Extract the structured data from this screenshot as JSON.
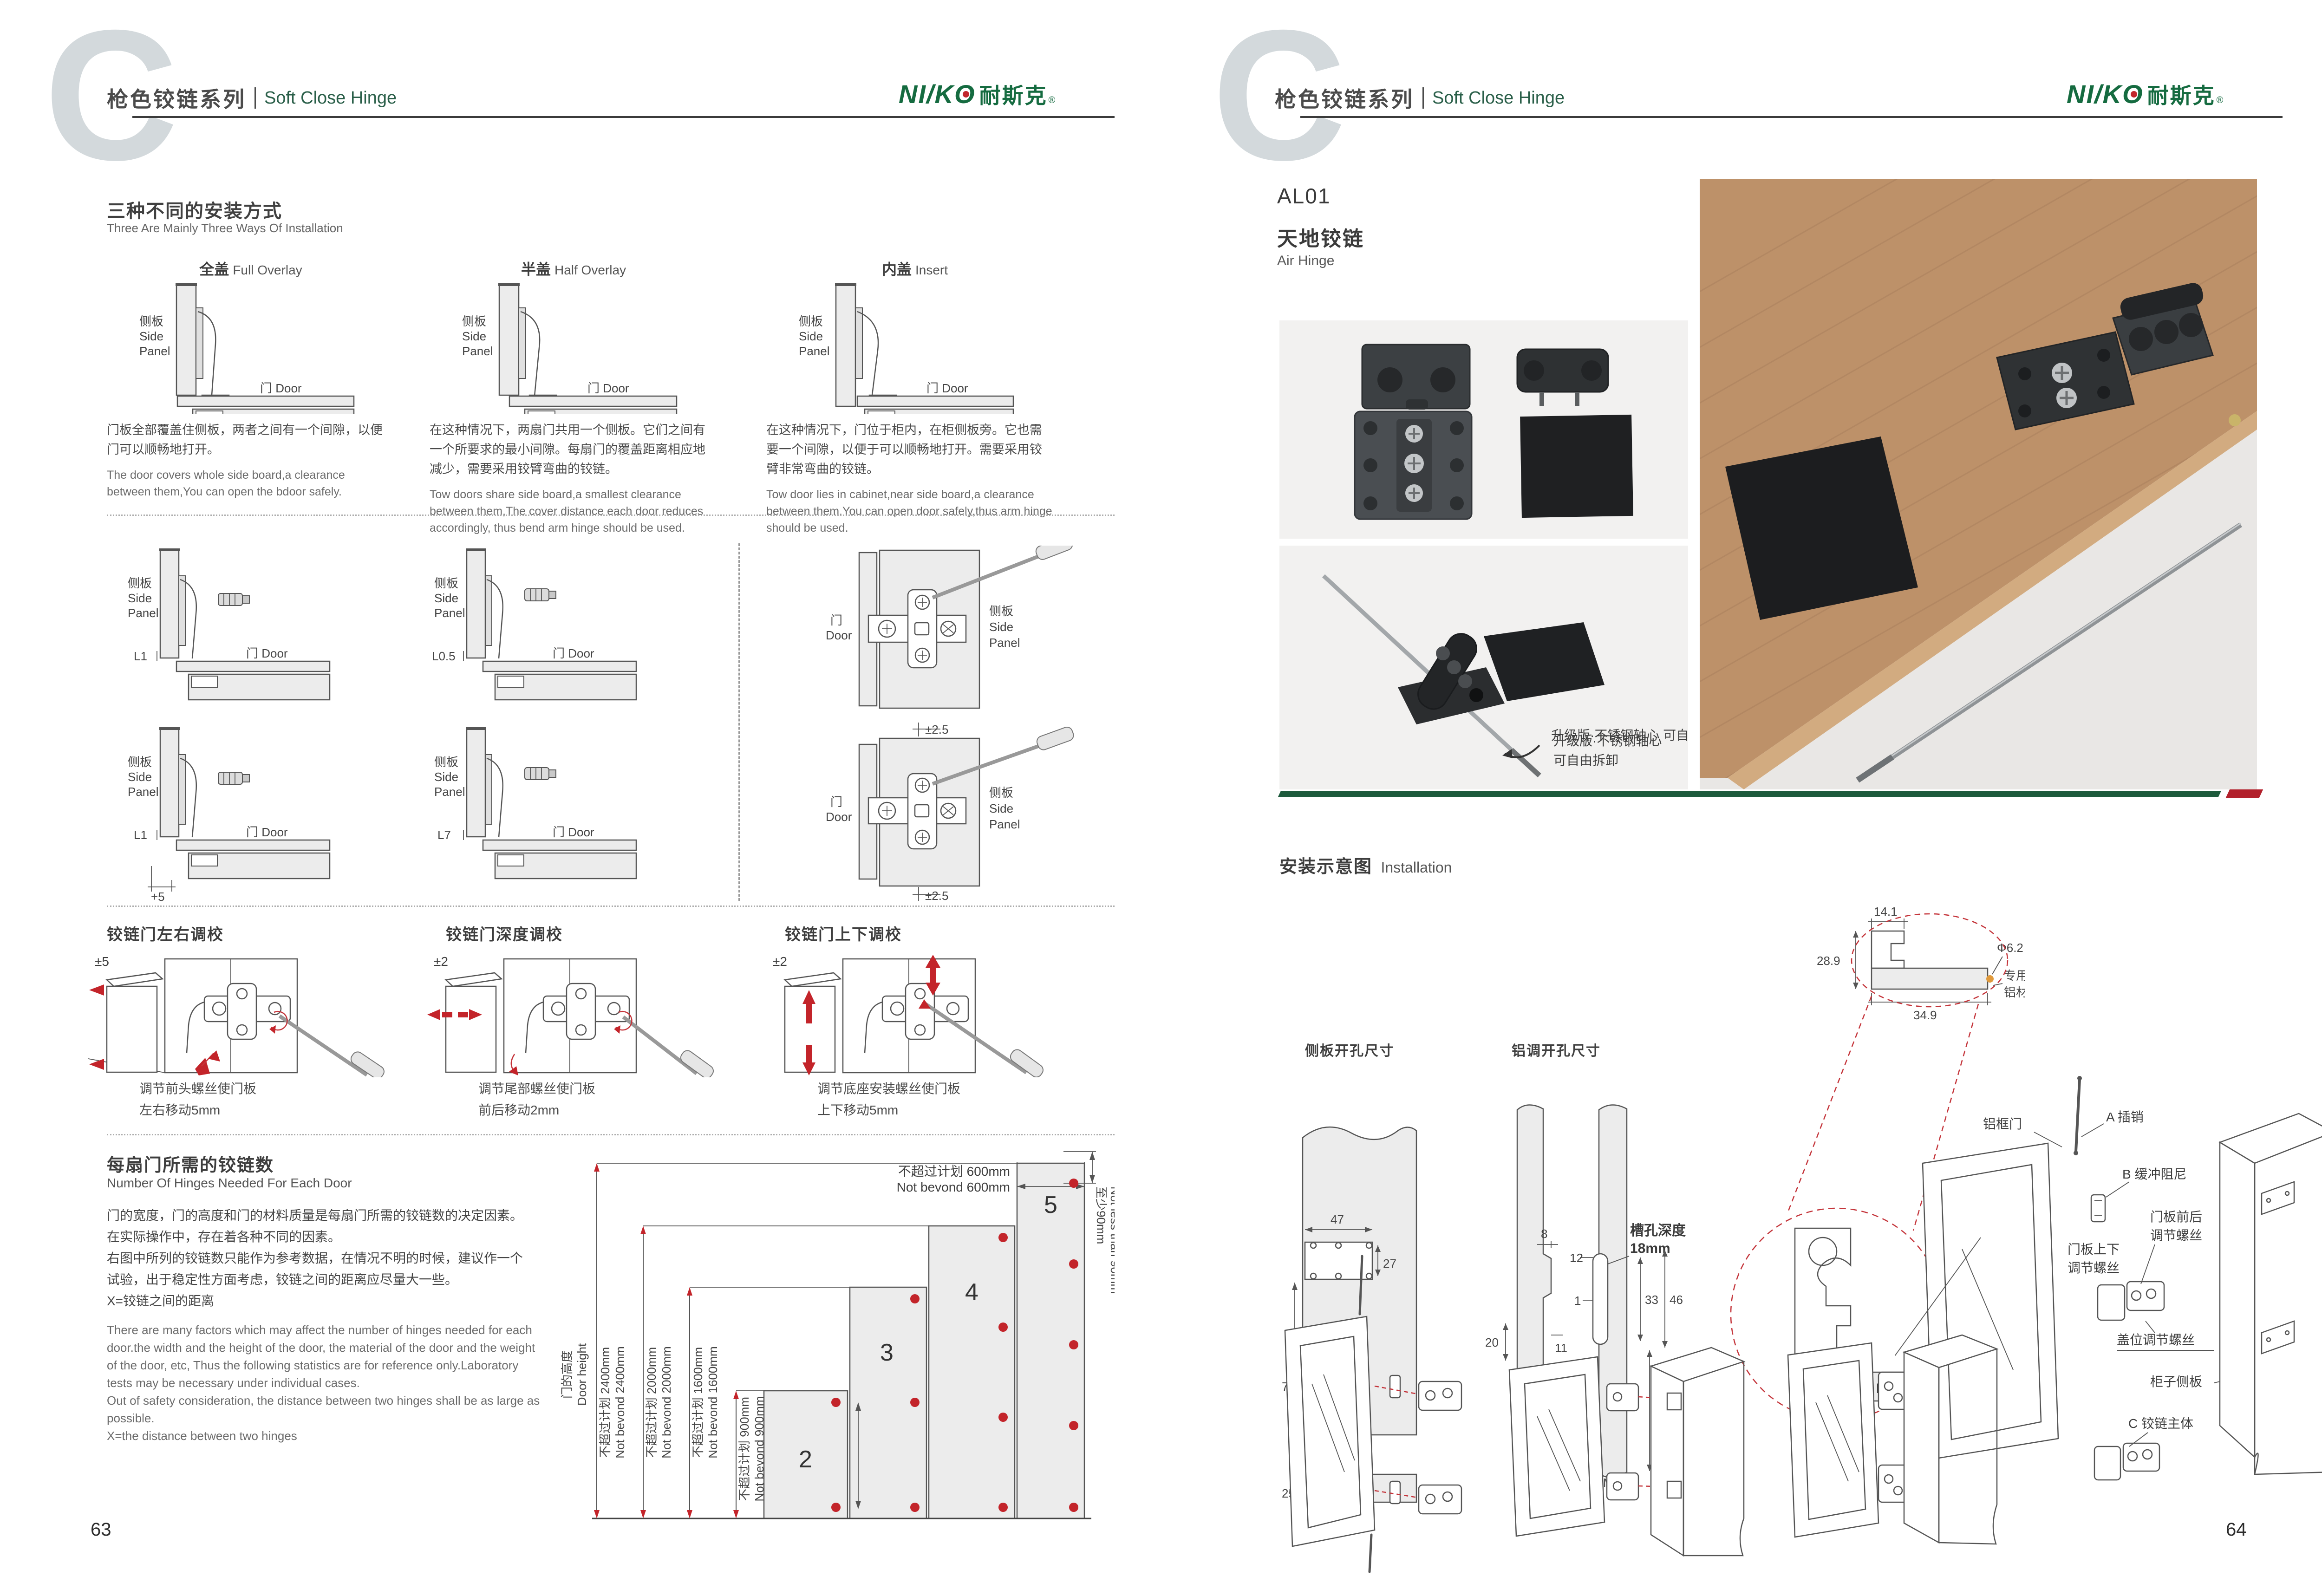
{
  "colors": {
    "brand_green": "#156b40",
    "accent_red": "#c0242b",
    "divider_green": "#1d5a3c",
    "header_gray": "#4b4b4b",
    "header_en_green": "#2a5f49"
  },
  "brand": {
    "logo_part1": "NI/K",
    "logo_o": "O",
    "logo_cn": "耐斯克",
    "reg": "®"
  },
  "header": {
    "series_cn": "枪色铰链系列",
    "series_en": "Soft Close Hinge",
    "watermark": "C"
  },
  "common": {
    "side_cn": "侧板",
    "side_en1": "Side",
    "side_en2": "Panel",
    "door": "门 Door",
    "door_cn": "门",
    "door_en": "Door"
  },
  "page_left": {
    "page_number": "63",
    "ways": {
      "title_cn": "三种不同的安装方式",
      "title_en": "Three Are Mainly Three Ways Of Installation",
      "cols": [
        {
          "cn": "全盖",
          "en": "Full Overlay",
          "desc_cn": "门板全部覆盖住侧板，两者之间有一个间隙，以便门可以顺畅地打开。",
          "desc_en": "The door covers whole side board,a clearance between them,You can open the bdoor safely."
        },
        {
          "cn": "半盖",
          "en": "Half Overlay",
          "desc_cn": "在这种情况下，两扇门共用一个侧板。它们之间有一个所要求的最小间隙。每扇门的覆盖距离相应地减少，需要采用铰臂弯曲的铰链。",
          "desc_en": "Tow doors share side board,a smallest clearance between them,The cover distance each door reduces accordingly, thus bend arm hinge should be used."
        },
        {
          "cn": "内盖",
          "en": "Insert",
          "desc_cn": "在这种情况下，门位于柜内，在柜侧板旁。它也需要一个间隙，以便于可以顺畅地打开。需要采用铰臂非常弯曲的铰链。",
          "desc_en": "Tow door lies in cabinet,near side board,a clearance between them.You can open door safely,thus arm hinge should be used."
        }
      ]
    },
    "gaps": {
      "dims": [
        "L1",
        "L0.5",
        "L1",
        "L7"
      ],
      "plus5": "+5",
      "pm_top": "±2.5",
      "pm_bottom": "±2.5"
    },
    "adjust": {
      "items": [
        {
          "title": "铰链门左右调校",
          "range": "±5",
          "caption": "调节前头螺丝使门板\n左右移动5mm"
        },
        {
          "title": "铰链门深度调校",
          "range": "±2",
          "caption": "调节尾部螺丝使门板\n前后移动2mm"
        },
        {
          "title": "铰链门上下调校",
          "range": "±2",
          "caption": "调节底座安装螺丝使门板\n上下移动5mm"
        }
      ]
    },
    "hinges": {
      "title_cn": "每扇门所需的铰链数",
      "title_en": "Number Of Hinges Needed For Each Door",
      "desc_cn": "门的宽度，门的高度和门的材料质量是每扇门所需的铰链数的决定因素。\n在实际操作中，存在着各种不同的因素。\n右图中所列的铰链数只能作为参考数据，在情况不明的时候，建议作一个\n试验，出于稳定性方面考虑，铰链之间的距离应尽量大一些。\nX=铰链之间的距离",
      "desc_en": "There are many factors which may affect the number of hinges needed for each\ndoor.the width and the height of the door, the material of the door and the weight\nof the door, etc, Thus the following statistics are for reference only.Laboratory\ntests may be necessary under individual cases.\nOut of safety consideration, the distance between two hinges shall be as large as\npossible.\nX=the distance between two hinges",
      "chart": {
        "height_cn": "门的高度",
        "height_en": "Door height",
        "rows": [
          {
            "cn": "不超过计划 2400mm",
            "en": "Not bevond 2400mm"
          },
          {
            "cn": "不超过计划 2000mm",
            "en": "Not bevond 2000mm"
          },
          {
            "cn": "不超过计划 1600mm",
            "en": "Not bevond 1600mm"
          },
          {
            "cn": "不超过计划 900mm",
            "en": "Not bevond 900mm"
          }
        ],
        "width_cn": "不超过计划 600mm",
        "width_en": "Not bevond 600mm",
        "min_cn": "至少90mm",
        "min_en": "Not less than 90mm",
        "bars": [
          "2",
          "3",
          "4",
          "5"
        ]
      }
    }
  },
  "page_right": {
    "page_number": "64",
    "product": {
      "code": "AL01",
      "name_cn": "天地铰链",
      "name_en": "Air Hinge"
    },
    "photo_note": "升级版·不锈钢轴心\n可自由拆卸",
    "install": {
      "title_cn": "安装示意图",
      "title_en": "Installation",
      "label_side": "侧板开孔尺寸",
      "label_alu": "铝调开孔尺寸",
      "a": {
        "d47": "47",
        "d27": "27",
        "d77": "77",
        "d25": "25"
      },
      "b": {
        "slot1": "槽孔深度",
        "slot2": "18mm",
        "d8": "8",
        "d20": "20",
        "d11": "11",
        "d12": "12",
        "d1": "1",
        "d33": "33",
        "d46": "46",
        "d155": "15.5",
        "m5": "M5"
      },
      "c": {
        "d141": "14.1",
        "d289": "28.9",
        "dia": "Φ6.2",
        "d349": "34.9",
        "alu1": "专用",
        "alu2": "铝材",
        "m5": "M5",
        "scale": "1:5"
      },
      "d": {
        "door": "铝框门",
        "pin": "A 插销",
        "damper": "B 缓冲阻尼",
        "fb1": "门板前后",
        "fb2": "调节螺丝",
        "ud1": "门板上下",
        "ud2": "调节螺丝",
        "cover": "盖位调节螺丝",
        "cab": "柜子侧板",
        "body": "C 铰链主体"
      }
    }
  },
  "chart_data": {
    "type": "bar",
    "title": "每扇门所需的铰链数 Number Of Hinges Needed For Each Door",
    "categories": [
      "不超过900mm door height",
      "不超过1600mm door height",
      "不超过2000mm door height",
      "不超过2400mm door height"
    ],
    "values": [
      2,
      3,
      4,
      5
    ],
    "xlabel": "门宽 不超过计划 600mm Not bevond 600mm",
    "ylabel": "门的高度 Door height",
    "annotations": [
      "至少90mm Not less than 90mm",
      "X=铰链之间的距离 X=the distance between two hinges"
    ],
    "legend_position": "none",
    "grid": false
  }
}
